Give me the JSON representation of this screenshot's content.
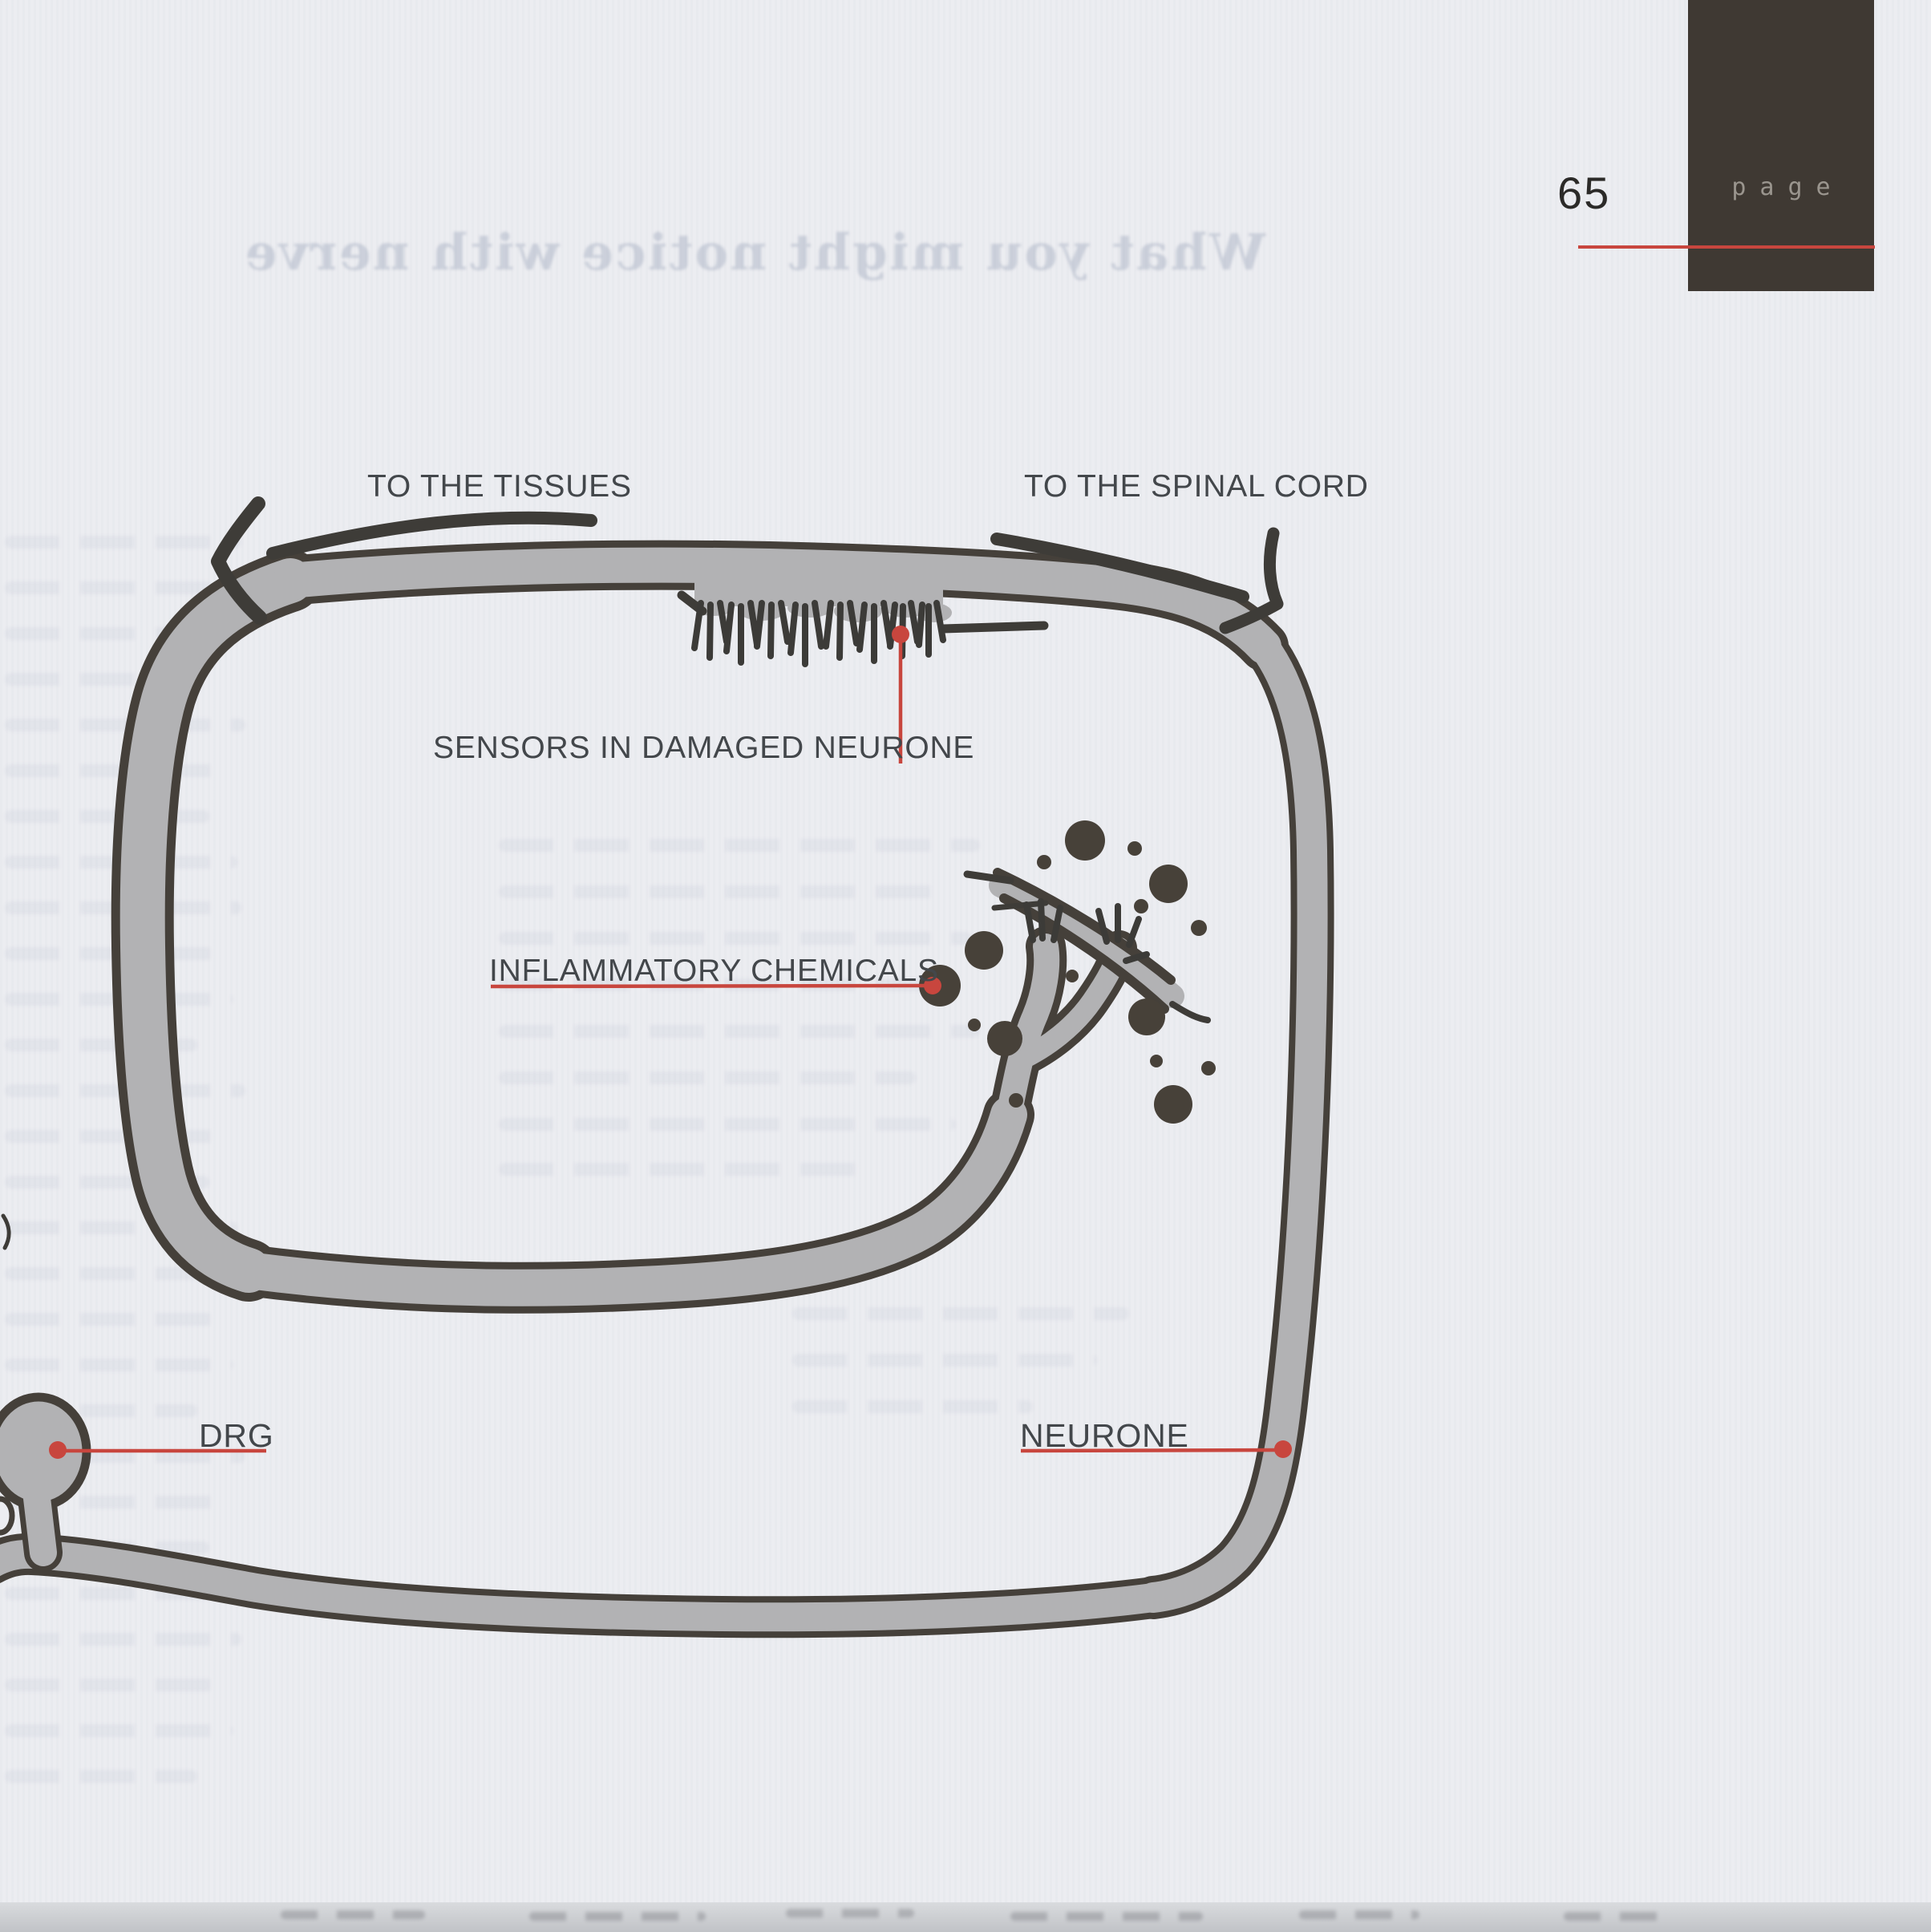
{
  "page_header": {
    "page_number": "65",
    "corner_label": "page"
  },
  "ghost_bleedthrough": {
    "title_reversed_text": "What you might notice with nerve"
  },
  "diagram": {
    "labels": {
      "to_the_tissues": "TO THE TISSUES",
      "to_the_spinal_cord": "TO THE SPINAL CORD",
      "sensors_in_damaged_neurone": "SENSORS IN DAMAGED NEURONE",
      "inflammatory_chemicals": "INFLAMMATORY CHEMICALS",
      "drg": "DRG",
      "neurone": "NEURONE"
    },
    "colors": {
      "accent_red": "#c8463e",
      "band_fill": "#b2b2b4",
      "band_outline": "#45403a",
      "chemical_dot": "#474139",
      "label_text": "#43474b",
      "corner_box": "#3f3933",
      "page_bg": "#ecedf1"
    }
  }
}
